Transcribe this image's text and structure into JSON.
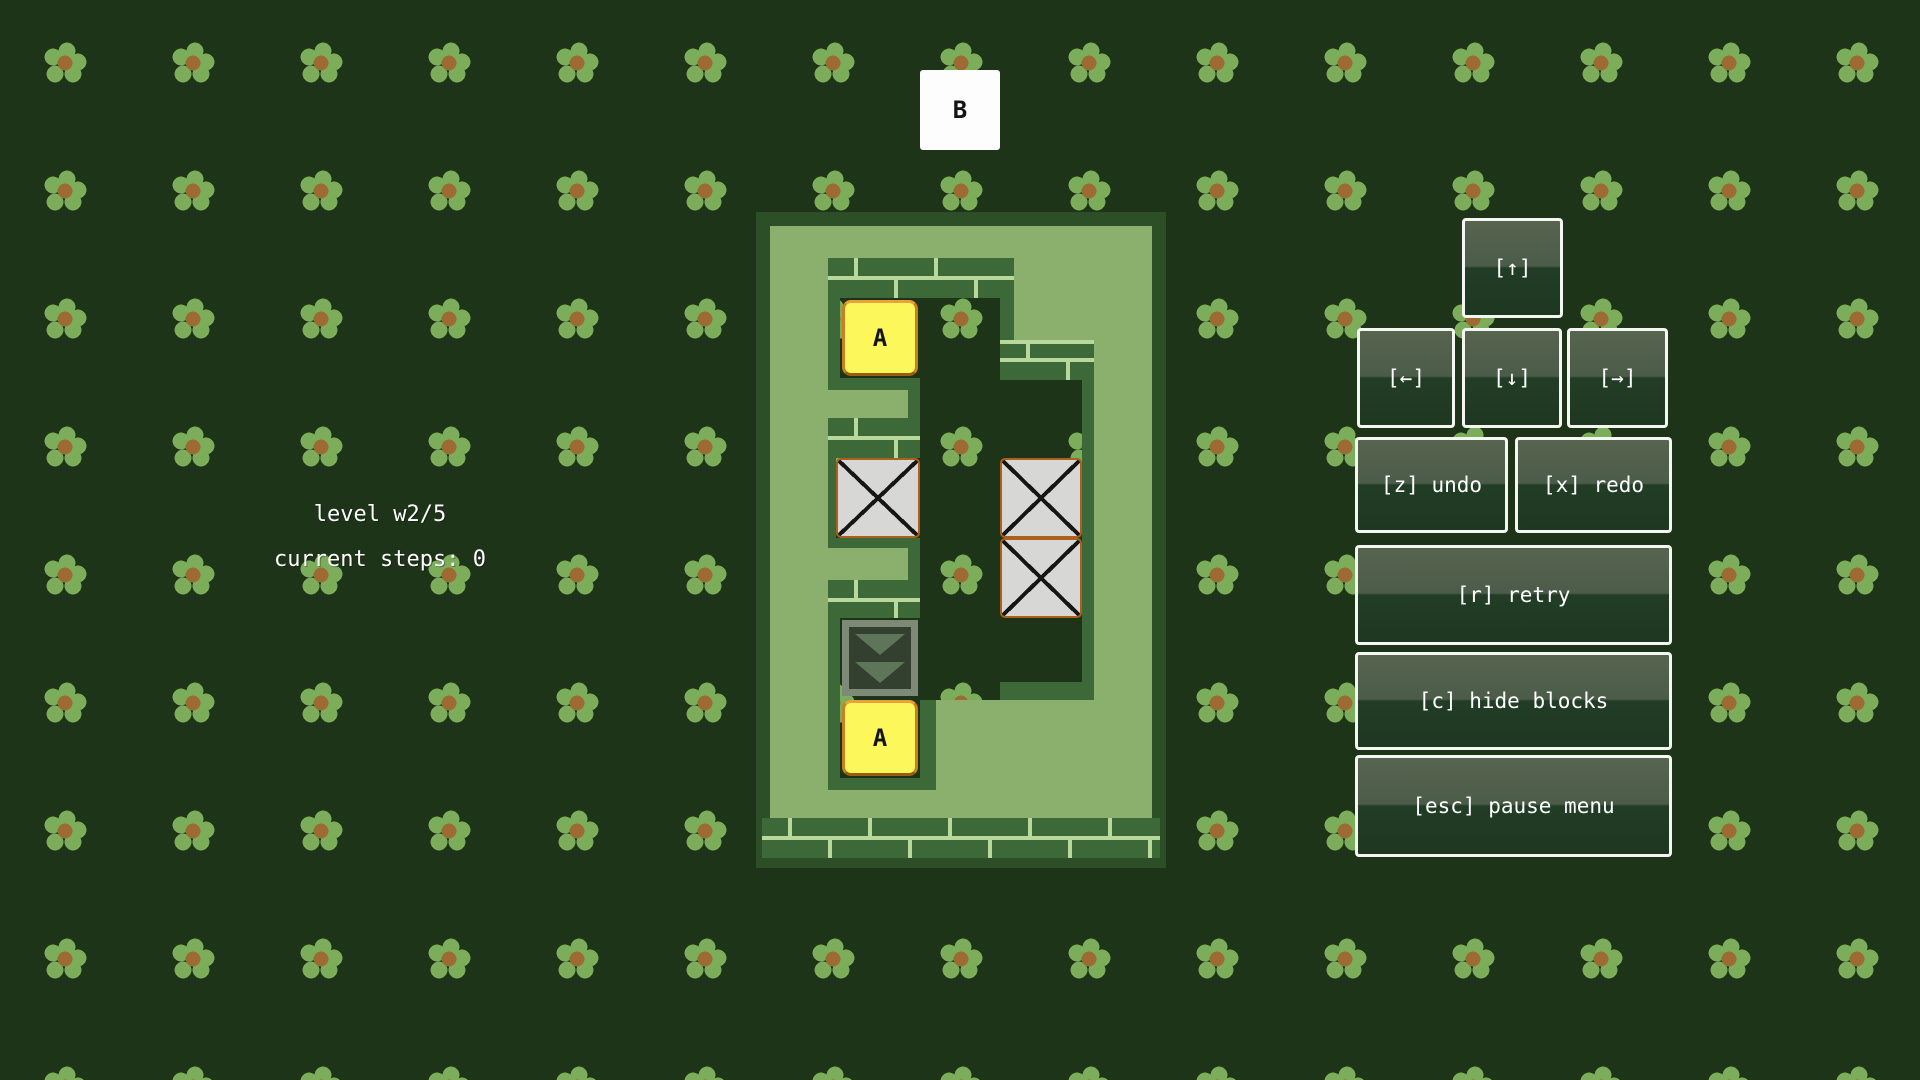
{
  "hud": {
    "level_label": "level w2/5",
    "steps_label": "current steps: 0"
  },
  "controls": {
    "up_label": "[↑]",
    "left_label": "[←]",
    "down_label": "[↓]",
    "right_label": "[→]",
    "undo_label": "[z] undo",
    "redo_label": "[x] redo",
    "retry_label": "[r] retry",
    "hide_blocks_label": "[c] hide blocks",
    "pause_label": "[esc] pause menu"
  },
  "board": {
    "goal_tile": {
      "label": "B",
      "grid": [
        2,
        -3
      ]
    },
    "letter_tiles": [
      {
        "id": "a1",
        "label": "A",
        "grid": [
          1,
          0
        ]
      },
      {
        "id": "a2",
        "label": "A",
        "grid": [
          1,
          5
        ]
      }
    ],
    "pushable_blocks": [
      {
        "id": "x1",
        "grid": [
          1,
          2
        ]
      },
      {
        "id": "x2",
        "grid": [
          3,
          2
        ]
      },
      {
        "id": "x3",
        "grid": [
          3,
          3
        ]
      }
    ],
    "conveyor": {
      "direction": "down",
      "chevrons": 2,
      "grid": [
        1,
        4
      ]
    }
  },
  "colors": {
    "background": "#1e3418",
    "grass_field": "#8bb06d",
    "hedge_wall": "#3d6838",
    "mortar": "#b9d89b",
    "letter_tile": "#fcf75a",
    "letter_tile_border": "#c97e1f",
    "block": "#d7d7d5",
    "block_border": "#ad5f1b",
    "goal_tile": "#fdfdfd",
    "flower_petal": "#7bad5b",
    "flower_center": "#9e6a33",
    "text": "#ffffff"
  }
}
